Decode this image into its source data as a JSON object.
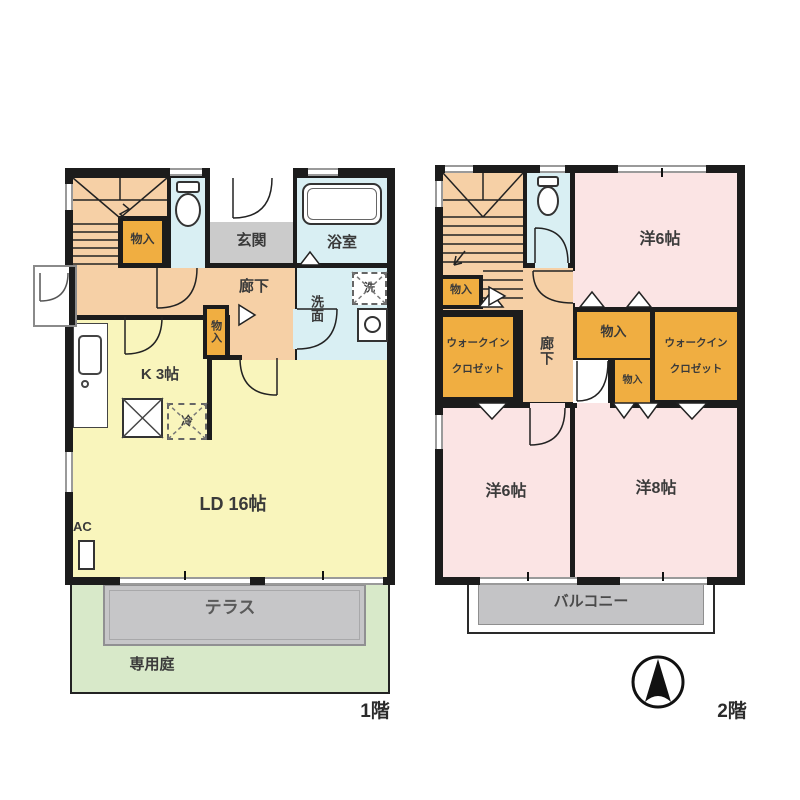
{
  "plan_title": "2-story floor plan",
  "colors": {
    "wall": "#1c1c1c",
    "hallway_tan": "#f6d0a6",
    "storage_orange": "#f0ae41",
    "water_blue": "#d9eff3",
    "entrance_gray": "#cbcbcb",
    "living_yellow": "#f9f5bc",
    "bedroom_pink": "#fbe4e4",
    "terrace_gray": "#c6c6c8",
    "garden_green": "#d8e9c9"
  },
  "floor1": {
    "caption": "1階",
    "labels": {
      "stair_storage": "物入",
      "entrance": "玄関",
      "bath": "浴室",
      "hallway": "廊下",
      "washroom": "洗面",
      "washer": "洗",
      "hall_storage": "物入",
      "kitchen": "K 3帖",
      "fridge": "冷",
      "living": "LD 16帖",
      "ac": "AC",
      "terrace": "テラス",
      "garden": "専用庭"
    }
  },
  "floor2": {
    "caption": "2階",
    "labels": {
      "bedroom_top": "洋6帖",
      "storage_left": "物入",
      "wic_left1": "ウォークイン",
      "wic_left2": "クロゼット",
      "hallway": "廊下",
      "storage_center": "物入",
      "storage_small": "物入",
      "wic_right1": "ウォークイン",
      "wic_right2": "クロゼット",
      "bedroom_left": "洋6帖",
      "bedroom_right": "洋8帖",
      "balcony": "バルコニー"
    }
  },
  "icons": {
    "compass": "north-arrow-compass"
  }
}
